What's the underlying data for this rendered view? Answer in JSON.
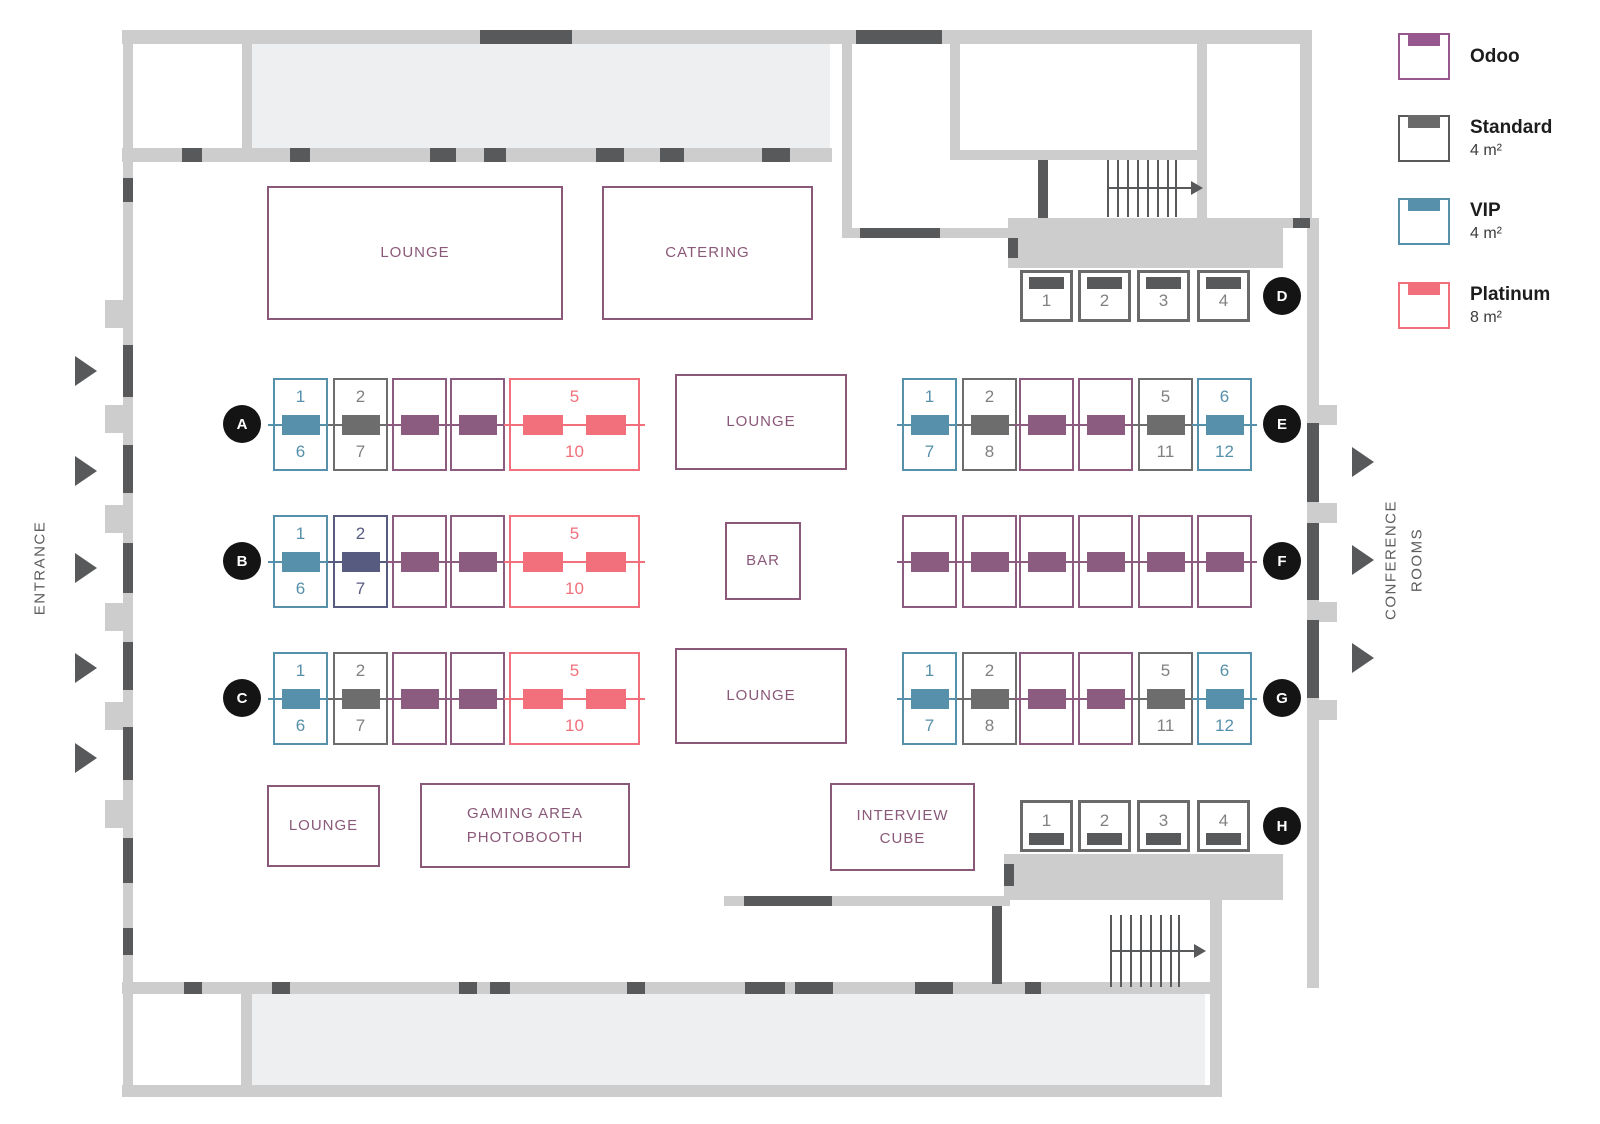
{
  "side_labels": {
    "entrance": "ENTRANCE",
    "conference_rooms": "CONFERENCE ROOMS"
  },
  "rooms": [
    {
      "id": "lounge-top",
      "label": "LOUNGE"
    },
    {
      "id": "catering",
      "label": "CATERING"
    },
    {
      "id": "lounge-mid",
      "label": "LOUNGE"
    },
    {
      "id": "bar",
      "label": "BAR"
    },
    {
      "id": "lounge-mid2",
      "label": "LOUNGE"
    },
    {
      "id": "lounge-bottom",
      "label": "LOUNGE"
    },
    {
      "id": "gaming",
      "label": "GAMING AREA PHOTOBOOTH"
    },
    {
      "id": "interview",
      "label": "INTERVIEW CUBE"
    }
  ],
  "legend": {
    "items": [
      {
        "label": "Odoo",
        "size": "",
        "outline": "#96588e",
        "bar": "#96588e"
      },
      {
        "label": "Standard",
        "size": "4 m²",
        "outline": "#5a5a5a",
        "bar": "#6a6a6a"
      },
      {
        "label": "VIP",
        "size": "4 m²",
        "outline": "#5790aa",
        "bar": "#5790aa"
      },
      {
        "label": "Platinum",
        "size": "8 m²",
        "outline": "#f1707b",
        "bar": "#f1707b"
      }
    ]
  },
  "colors": {
    "odoo": "#8b5c80",
    "standard": "#6d6d6d",
    "vip": "#5790aa",
    "platinum": "#f1707b",
    "sold": "#575b80",
    "standard_number": "#818181",
    "wall": "#cdcdcd",
    "wall_dark": "#58595b",
    "floor_fill": "#edeff0",
    "room_outline": "#8a5878",
    "marker": "#141414"
  },
  "booth_rows": [
    {
      "letter": "A",
      "booths": [
        {
          "type": "vip",
          "top": "1",
          "bottom": "6"
        },
        {
          "type": "standard",
          "top": "2",
          "bottom": "7"
        },
        {
          "type": "odoo"
        },
        {
          "type": "odoo"
        },
        {
          "type": "platinum",
          "top": "5",
          "bottom": "10"
        }
      ]
    },
    {
      "letter": "B",
      "booths": [
        {
          "type": "vip",
          "top": "1",
          "bottom": "6"
        },
        {
          "type": "sold",
          "top": "2",
          "bottom": "7"
        },
        {
          "type": "odoo"
        },
        {
          "type": "odoo"
        },
        {
          "type": "platinum",
          "top": "5",
          "bottom": "10"
        }
      ]
    },
    {
      "letter": "C",
      "booths": [
        {
          "type": "vip",
          "top": "1",
          "bottom": "6"
        },
        {
          "type": "standard",
          "top": "2",
          "bottom": "7"
        },
        {
          "type": "odoo"
        },
        {
          "type": "odoo"
        },
        {
          "type": "platinum",
          "top": "5",
          "bottom": "10"
        }
      ]
    },
    {
      "letter": "D",
      "booths": [
        {
          "type": "standard",
          "num": "1"
        },
        {
          "type": "standard",
          "num": "2"
        },
        {
          "type": "standard",
          "num": "3"
        },
        {
          "type": "standard",
          "num": "4"
        }
      ]
    },
    {
      "letter": "E",
      "booths": [
        {
          "type": "vip",
          "top": "1",
          "bottom": "7"
        },
        {
          "type": "standard",
          "top": "2",
          "bottom": "8"
        },
        {
          "type": "odoo"
        },
        {
          "type": "odoo"
        },
        {
          "type": "standard",
          "top": "5",
          "bottom": "11"
        },
        {
          "type": "vip",
          "top": "6",
          "bottom": "12"
        }
      ]
    },
    {
      "letter": "F",
      "booths": [
        {
          "type": "odoo"
        },
        {
          "type": "odoo"
        },
        {
          "type": "odoo"
        },
        {
          "type": "odoo"
        },
        {
          "type": "odoo"
        },
        {
          "type": "odoo"
        }
      ]
    },
    {
      "letter": "G",
      "booths": [
        {
          "type": "vip",
          "top": "1",
          "bottom": "7"
        },
        {
          "type": "standard",
          "top": "2",
          "bottom": "8"
        },
        {
          "type": "odoo"
        },
        {
          "type": "odoo"
        },
        {
          "type": "standard",
          "top": "5",
          "bottom": "11"
        },
        {
          "type": "vip",
          "top": "6",
          "bottom": "12"
        }
      ]
    },
    {
      "letter": "H",
      "booths": [
        {
          "type": "standard",
          "num": "1"
        },
        {
          "type": "standard",
          "num": "2"
        },
        {
          "type": "standard",
          "num": "3"
        },
        {
          "type": "standard",
          "num": "4"
        }
      ]
    }
  ]
}
